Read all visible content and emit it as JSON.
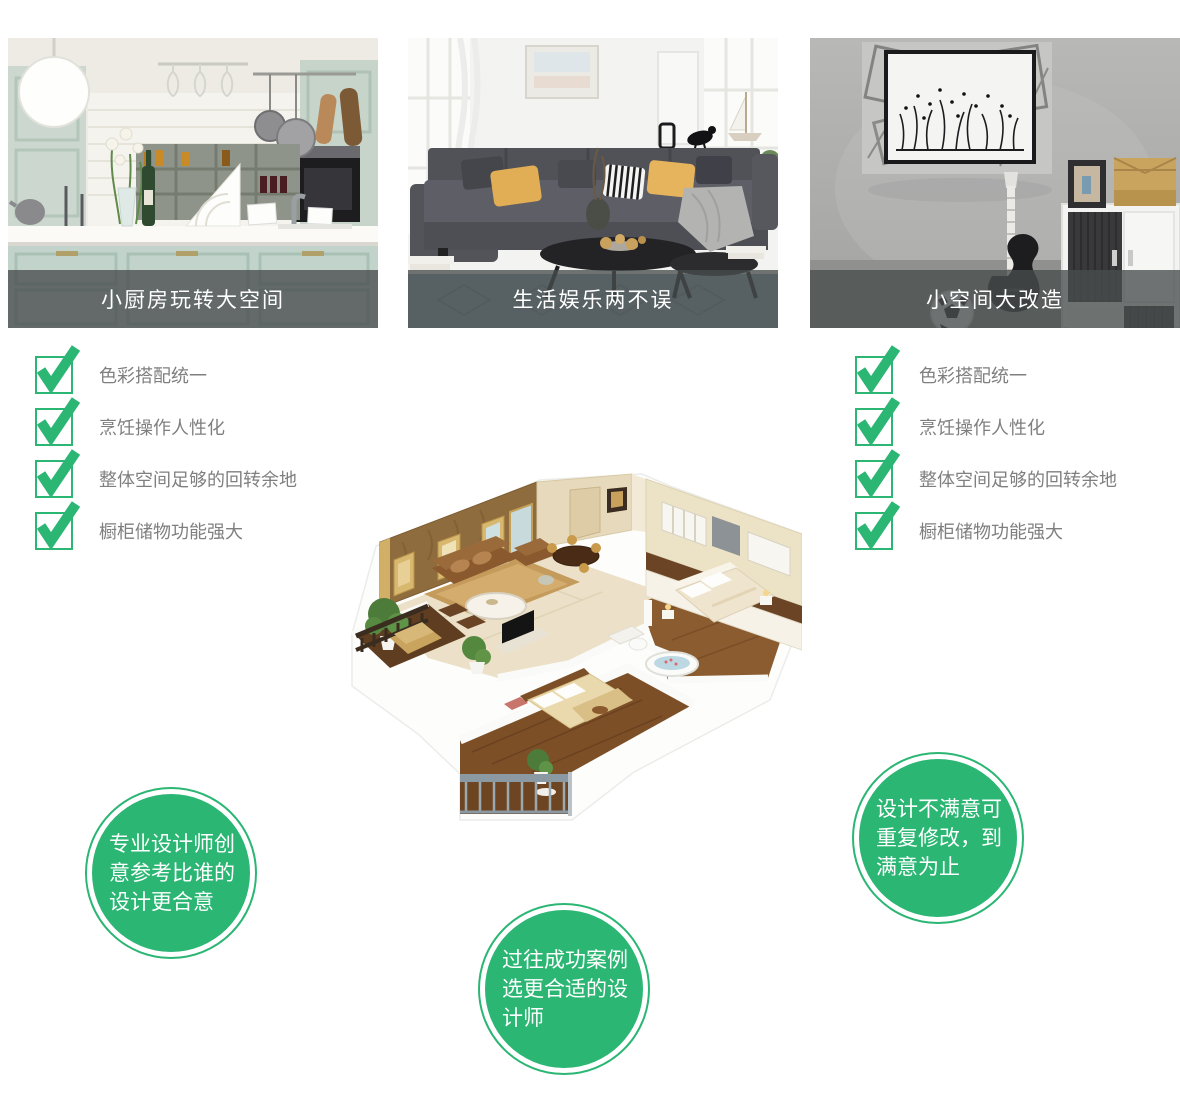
{
  "colors": {
    "green": "#2bb673",
    "caption_bg": "rgba(72,77,77,0.78)",
    "caption_text": "#ffffff",
    "checklist_text": "#7f7f7f",
    "bubble_text": "#ffffff"
  },
  "cards": [
    {
      "caption": "小厨房玩转大空间",
      "photo": "kitchen-showcase-photo"
    },
    {
      "caption": "生活娱乐两不误",
      "photo": "living-room-showcase-photo"
    },
    {
      "caption": "小空间大改造",
      "photo": "small-space-showcase-photo"
    }
  ],
  "checklist_left": {
    "items": [
      "色彩搭配统一",
      "烹饪操作人性化",
      "整体空间足够的回转余地",
      "橱柜储物功能强大"
    ]
  },
  "checklist_right": {
    "items": [
      "色彩搭配统一",
      "烹饪操作人性化",
      "整体空间足够的回转余地",
      "橱柜储物功能强大"
    ]
  },
  "bubbles": {
    "designer": "专业设计师创意参考比谁的设计更合意",
    "cases": "过往成功案例选更合适的设计师",
    "revision": "设计不满意可重复修改，到满意为止"
  },
  "floorplan": {
    "illustration": "isometric-apartment-3d-floorplan"
  }
}
